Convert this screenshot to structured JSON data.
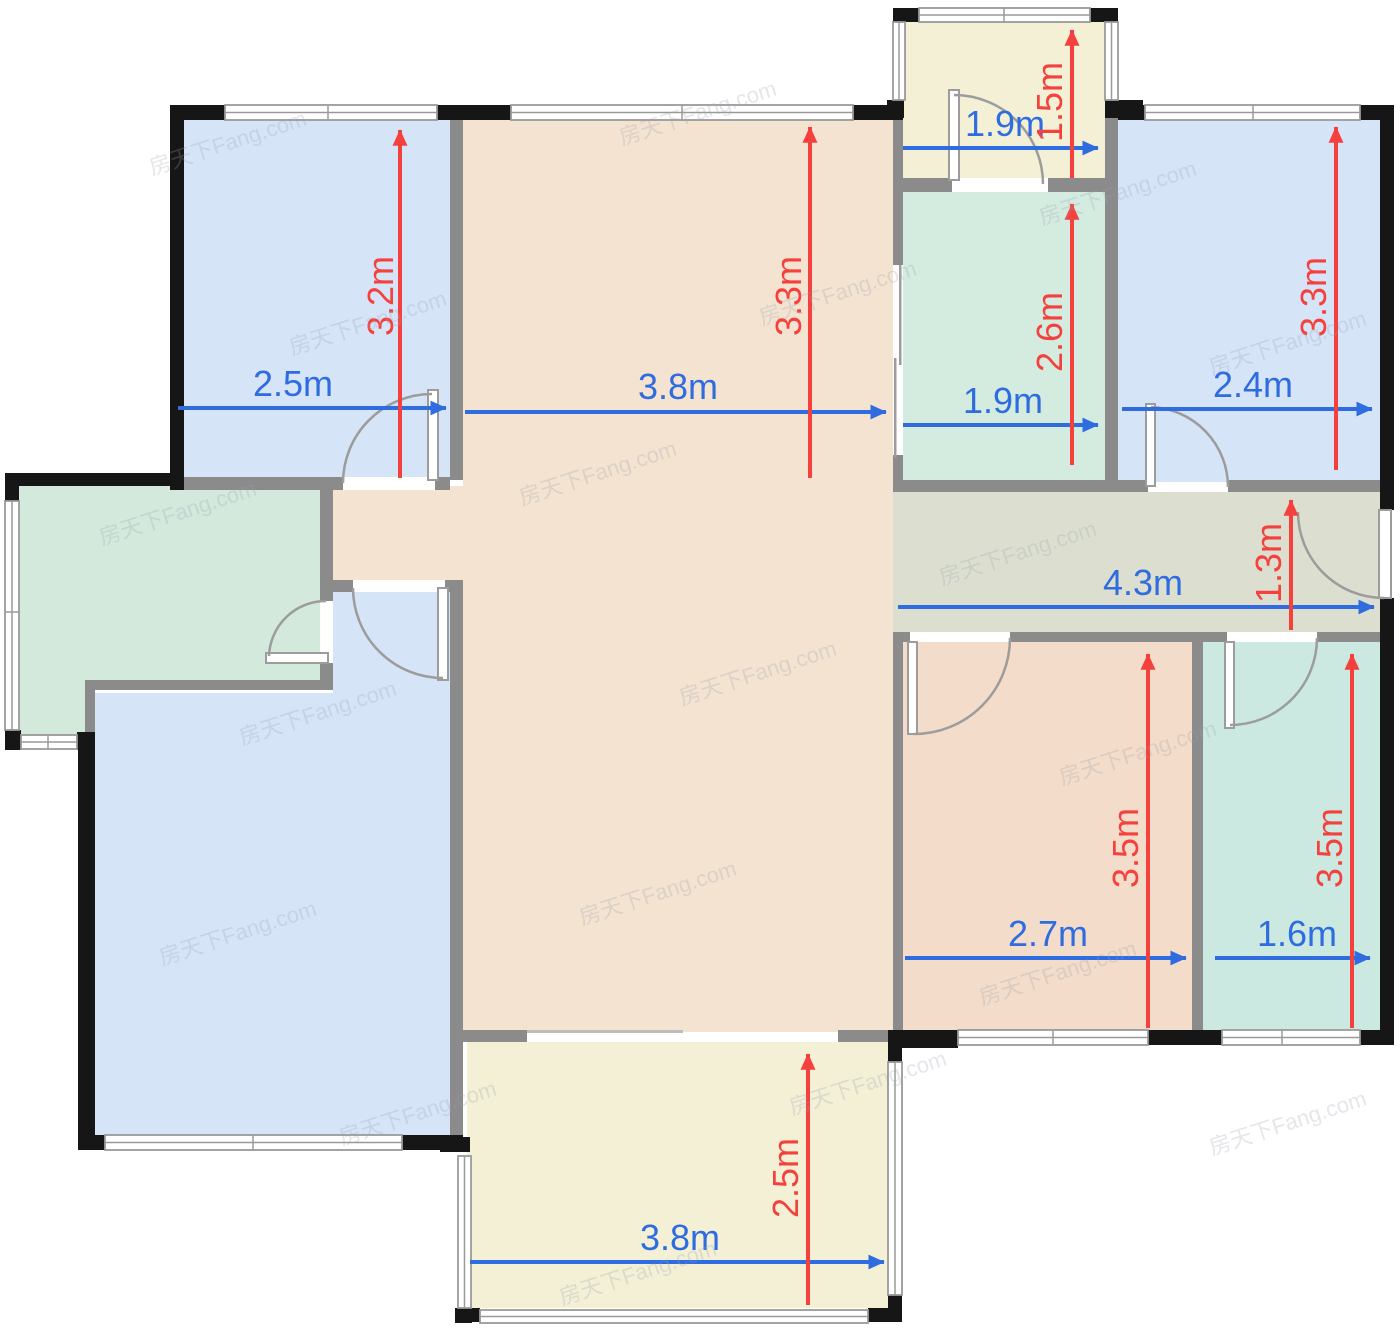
{
  "watermark": {
    "text": "房天下Fang.com"
  },
  "palette": {
    "room_blue": "#d6e4f8",
    "room_living_beige": "#f4e3d1",
    "room_bedroom_beige": "#f3dcc9",
    "room_balcony_yellow": "#f3f0d6",
    "room_kitchen_green": "#d2e9dc",
    "room_bath_mint": "#d4ebdf",
    "room_bath_teal": "#cbe8e1",
    "room_corridor": "#dcdfd0",
    "wall_interior_gray": "#8b8b8b",
    "wall_exterior_black": "#161616",
    "dimension_blue": "#2e6ce0",
    "dimension_red": "#f5413e",
    "door_window_gray": "#9c9c9c"
  },
  "rooms": [
    {
      "id": "bedroom-top-left",
      "width_label": "2.5m",
      "height_label": "3.2m"
    },
    {
      "id": "living-room",
      "width_label": "3.8m",
      "height_label": "3.3m"
    },
    {
      "id": "balcony-top",
      "width_label": "1.9m",
      "height_label": "1.5m"
    },
    {
      "id": "bathroom-top",
      "width_label": "1.9m",
      "height_label": "2.6m"
    },
    {
      "id": "bedroom-top-right",
      "width_label": "2.4m",
      "height_label": "3.3m"
    },
    {
      "id": "hallway",
      "width_label": "4.3m",
      "height_label": "1.3m"
    },
    {
      "id": "bedroom-bottom",
      "width_label": "2.7m",
      "height_label": "3.5m"
    },
    {
      "id": "bathroom-bottom-right",
      "width_label": "1.6m",
      "height_label": "3.5m"
    },
    {
      "id": "balcony-bottom",
      "width_label": "3.8m",
      "height_label": "2.5m"
    }
  ]
}
